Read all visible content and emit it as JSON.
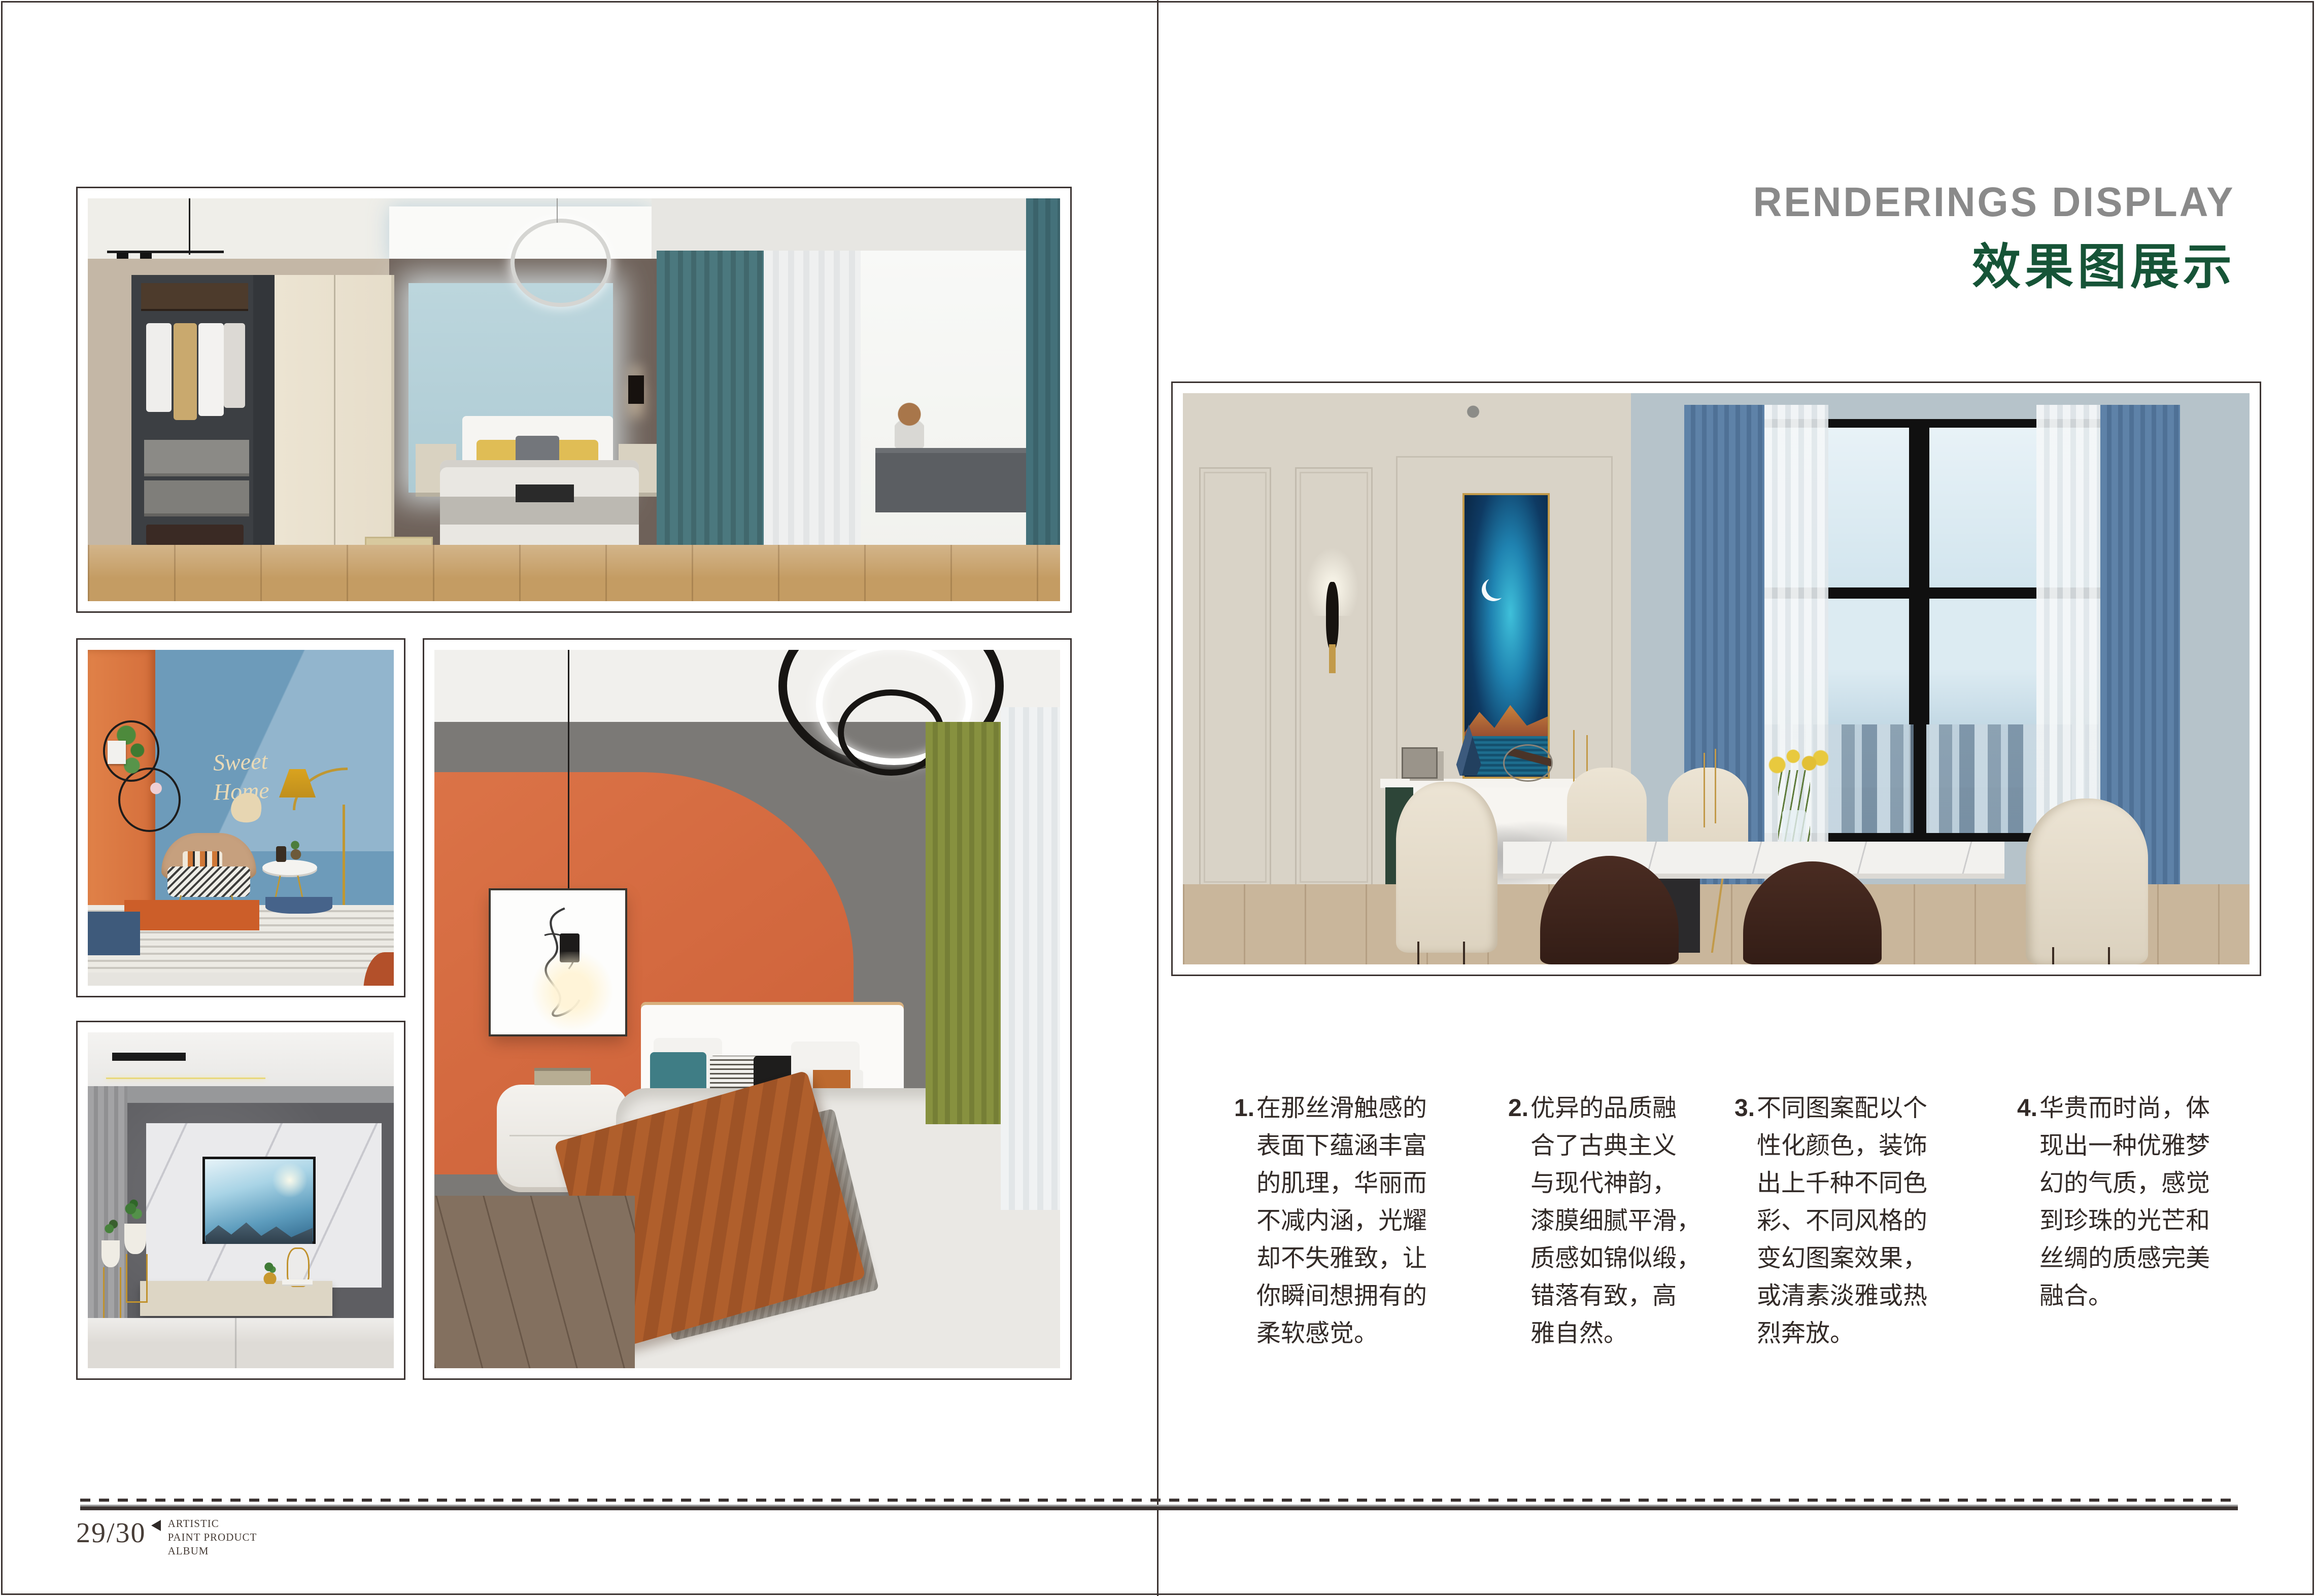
{
  "header": {
    "title_en": "RENDERINGS DISPLAY",
    "title_zh": "效果图展示"
  },
  "features": [
    {
      "num": "1.",
      "text": "在那丝滑触感的\n表面下蕴涵丰富\n的肌理，华丽而\n不减内涵，光耀\n却不失雅致，让\n你瞬间想拥有的\n柔软感觉。"
    },
    {
      "num": "2.",
      "text": "优异的品质融\n合了古典主义\n与现代神韵，\n漆膜细腻平滑，\n质感如锦似缎，\n错落有致，高\n雅自然。"
    },
    {
      "num": "3.",
      "text": "不同图案配以个\n性化颜色，装饰\n出上千种不同色\n彩、不同风格的\n变幻图案效果，\n或清素淡雅或热\n烈奔放。"
    },
    {
      "num": "4.",
      "text": "华贵而时尚，体\n现出一种优雅梦\n幻的气质，感觉\n到珍珠的光芒和\n丝绸的质感完美\n融合。"
    }
  ],
  "footer": {
    "page_number": "29/30",
    "album_line1": "ARTISTIC",
    "album_line2": "PAINT PRODUCT",
    "album_line3": "ALBUM"
  },
  "photos": {
    "sweet_home": {
      "line1": "Sweet",
      "line2": "Home"
    }
  },
  "colors": {
    "title_en": "#8a8a8a",
    "title_zh": "#165437",
    "rule": "#3b3331",
    "accent_orange": "#d4693f",
    "accent_blue_wall": "#6d9cbb",
    "accent_teal_curtain": "#4b787e",
    "accent_green_curtain": "#85903e"
  }
}
